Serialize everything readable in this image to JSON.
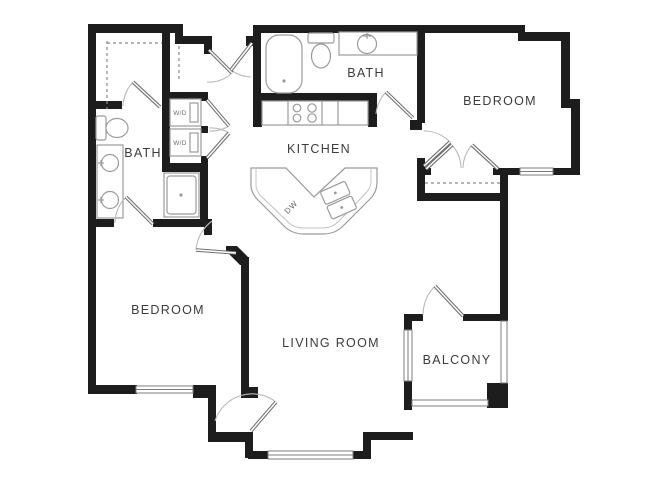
{
  "plan": {
    "rooms": {
      "bath_top": {
        "label": "BATH"
      },
      "bath_left": {
        "label": "BATH"
      },
      "kitchen": {
        "label": "KITCHEN"
      },
      "bedroom_right": {
        "label": "BEDROOM"
      },
      "bedroom_left": {
        "label": "BEDROOM"
      },
      "living_room": {
        "label": "LIVING ROOM"
      },
      "balcony": {
        "label": "BALCONY"
      }
    },
    "appliances": {
      "washer_dryer_1": {
        "label": "W/D"
      },
      "washer_dryer_2": {
        "label": "W/D"
      },
      "dishwasher": {
        "label": "DW"
      }
    },
    "colors": {
      "wall": "#1d1d1d",
      "fixture_line": "#9b9b9b",
      "door_line": "#6e6e6e",
      "arc_line": "#b9b9b9",
      "dash_line": "#8a8a8a",
      "label_text": "#3c3c3c"
    }
  }
}
